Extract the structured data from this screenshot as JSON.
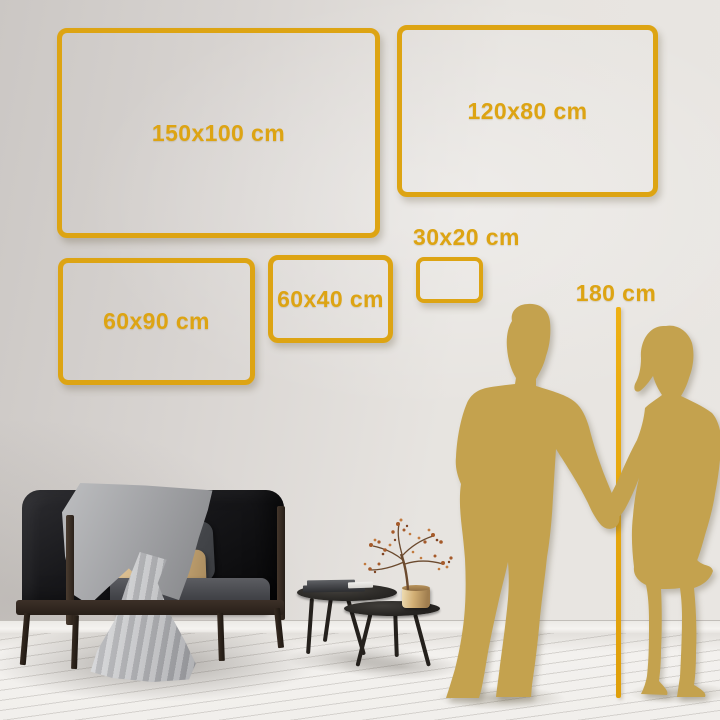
{
  "sizes": [
    {
      "label": "150x100 cm",
      "width_cm": 150,
      "height_cm": 100
    },
    {
      "label": "120x80 cm",
      "width_cm": 120,
      "height_cm": 80
    },
    {
      "label": "60x90 cm",
      "width_cm": 60,
      "height_cm": 90
    },
    {
      "label": "60x40 cm",
      "width_cm": 60,
      "height_cm": 40
    },
    {
      "label": "30x20 cm",
      "width_cm": 30,
      "height_cm": 20
    }
  ],
  "height_reference": {
    "label": "180 cm",
    "value_cm": 180
  },
  "colors": {
    "accent_gold": "#DDA413",
    "silhouette_gold": "#C4A24E",
    "measure_line_gold": "#E5A40E",
    "wall_gray": "#DDD9D5",
    "floor_white": "#F1EFEC"
  }
}
